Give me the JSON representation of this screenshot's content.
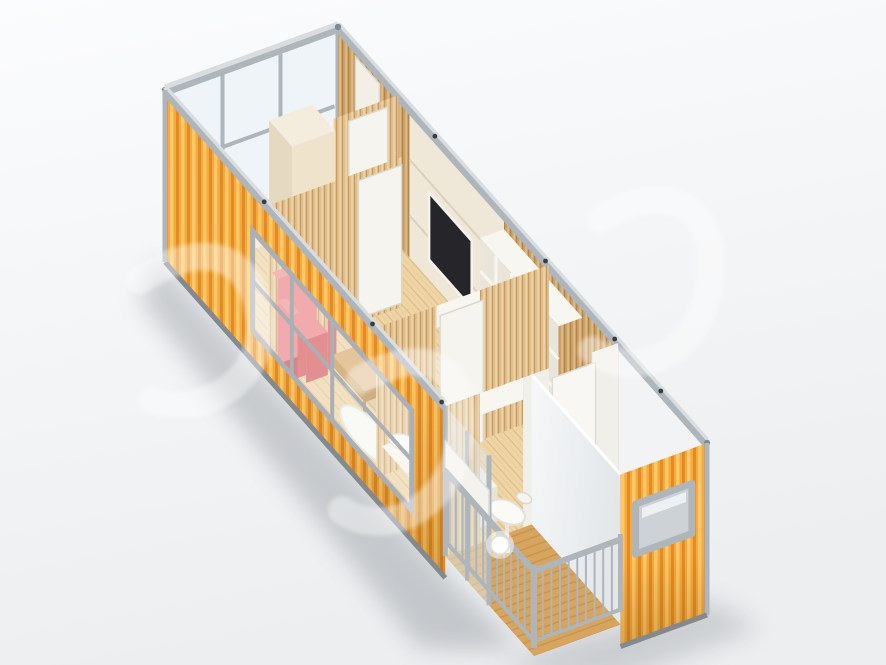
{
  "meta": {
    "type": "3d-render",
    "subject": "container-house-cutaway",
    "description": "Isometric 3D cutaway rendering of a prefabricated shipping-container home with the roof removed, viewed from above on a white studio background. Orange corrugated exterior walls with silver metal frame; wood-panelled interior.",
    "canvas": {
      "width": 886,
      "height": 665
    }
  },
  "watermark": {
    "present": true,
    "style": "faint-white-glyphs",
    "color": "#ffffff",
    "opacity": 0.45
  },
  "palette": {
    "bg-top": "#fbfcfd",
    "bg-bottom": "#eceef0",
    "shadow": "#7a8086",
    "frame-light": "#d9dde0",
    "frame-mid": "#aeb5bb",
    "frame-dark": "#82898f",
    "orange-base": "#f6a93d",
    "orange-light": "#ffc866",
    "orange-dark": "#e18c26",
    "orange-deep": "#c9761c",
    "wood-wall": "#cda26a",
    "wood-groove": "#b08649",
    "wood-highlight": "#e3c08d",
    "wood-bright": "#e0bf8e",
    "wood-bright-groove": "#c49c64",
    "floor-base": "#efd5a5",
    "floor-line": "#cfa871",
    "deck-base": "#d8a55e",
    "deck-line": "#b98a44",
    "cream-panel": "#efe7d7",
    "cream-seam": "#ddd2bd",
    "white-furniture": "#f8f6f0",
    "white-shade": "#e9e4d7",
    "tv-screen": "#26252a",
    "red-light": "#f29496",
    "red-mid": "#ec8486",
    "red-dark": "#d8595c",
    "red-deep": "#c44b4f",
    "glass-tint": "#dfe9ee",
    "glass-bright": "#eef4f7",
    "marble": "#f1f3f4",
    "marble-shade": "#dde2e6",
    "accent-blue": "#5ab4e4",
    "accent-yellow": "#e9c24a"
  },
  "scene": {
    "container": {
      "label": "container-house",
      "exterior": "orange corrugated steel",
      "frame": "silver-gray steel"
    },
    "rooms": [
      {
        "label": "entry room with glass end wall, wardrobe and vanity nook"
      },
      {
        "label": "living room with red armchair, wooden coffee table, wall TV and white shelving"
      },
      {
        "label": "bedroom with double bed and white bedding"
      },
      {
        "label": "bathroom with bathtub and marble walls"
      },
      {
        "label": "glass sunroom with round white table"
      },
      {
        "label": "balcony deck with metal railing and crystal lamp"
      }
    ]
  }
}
